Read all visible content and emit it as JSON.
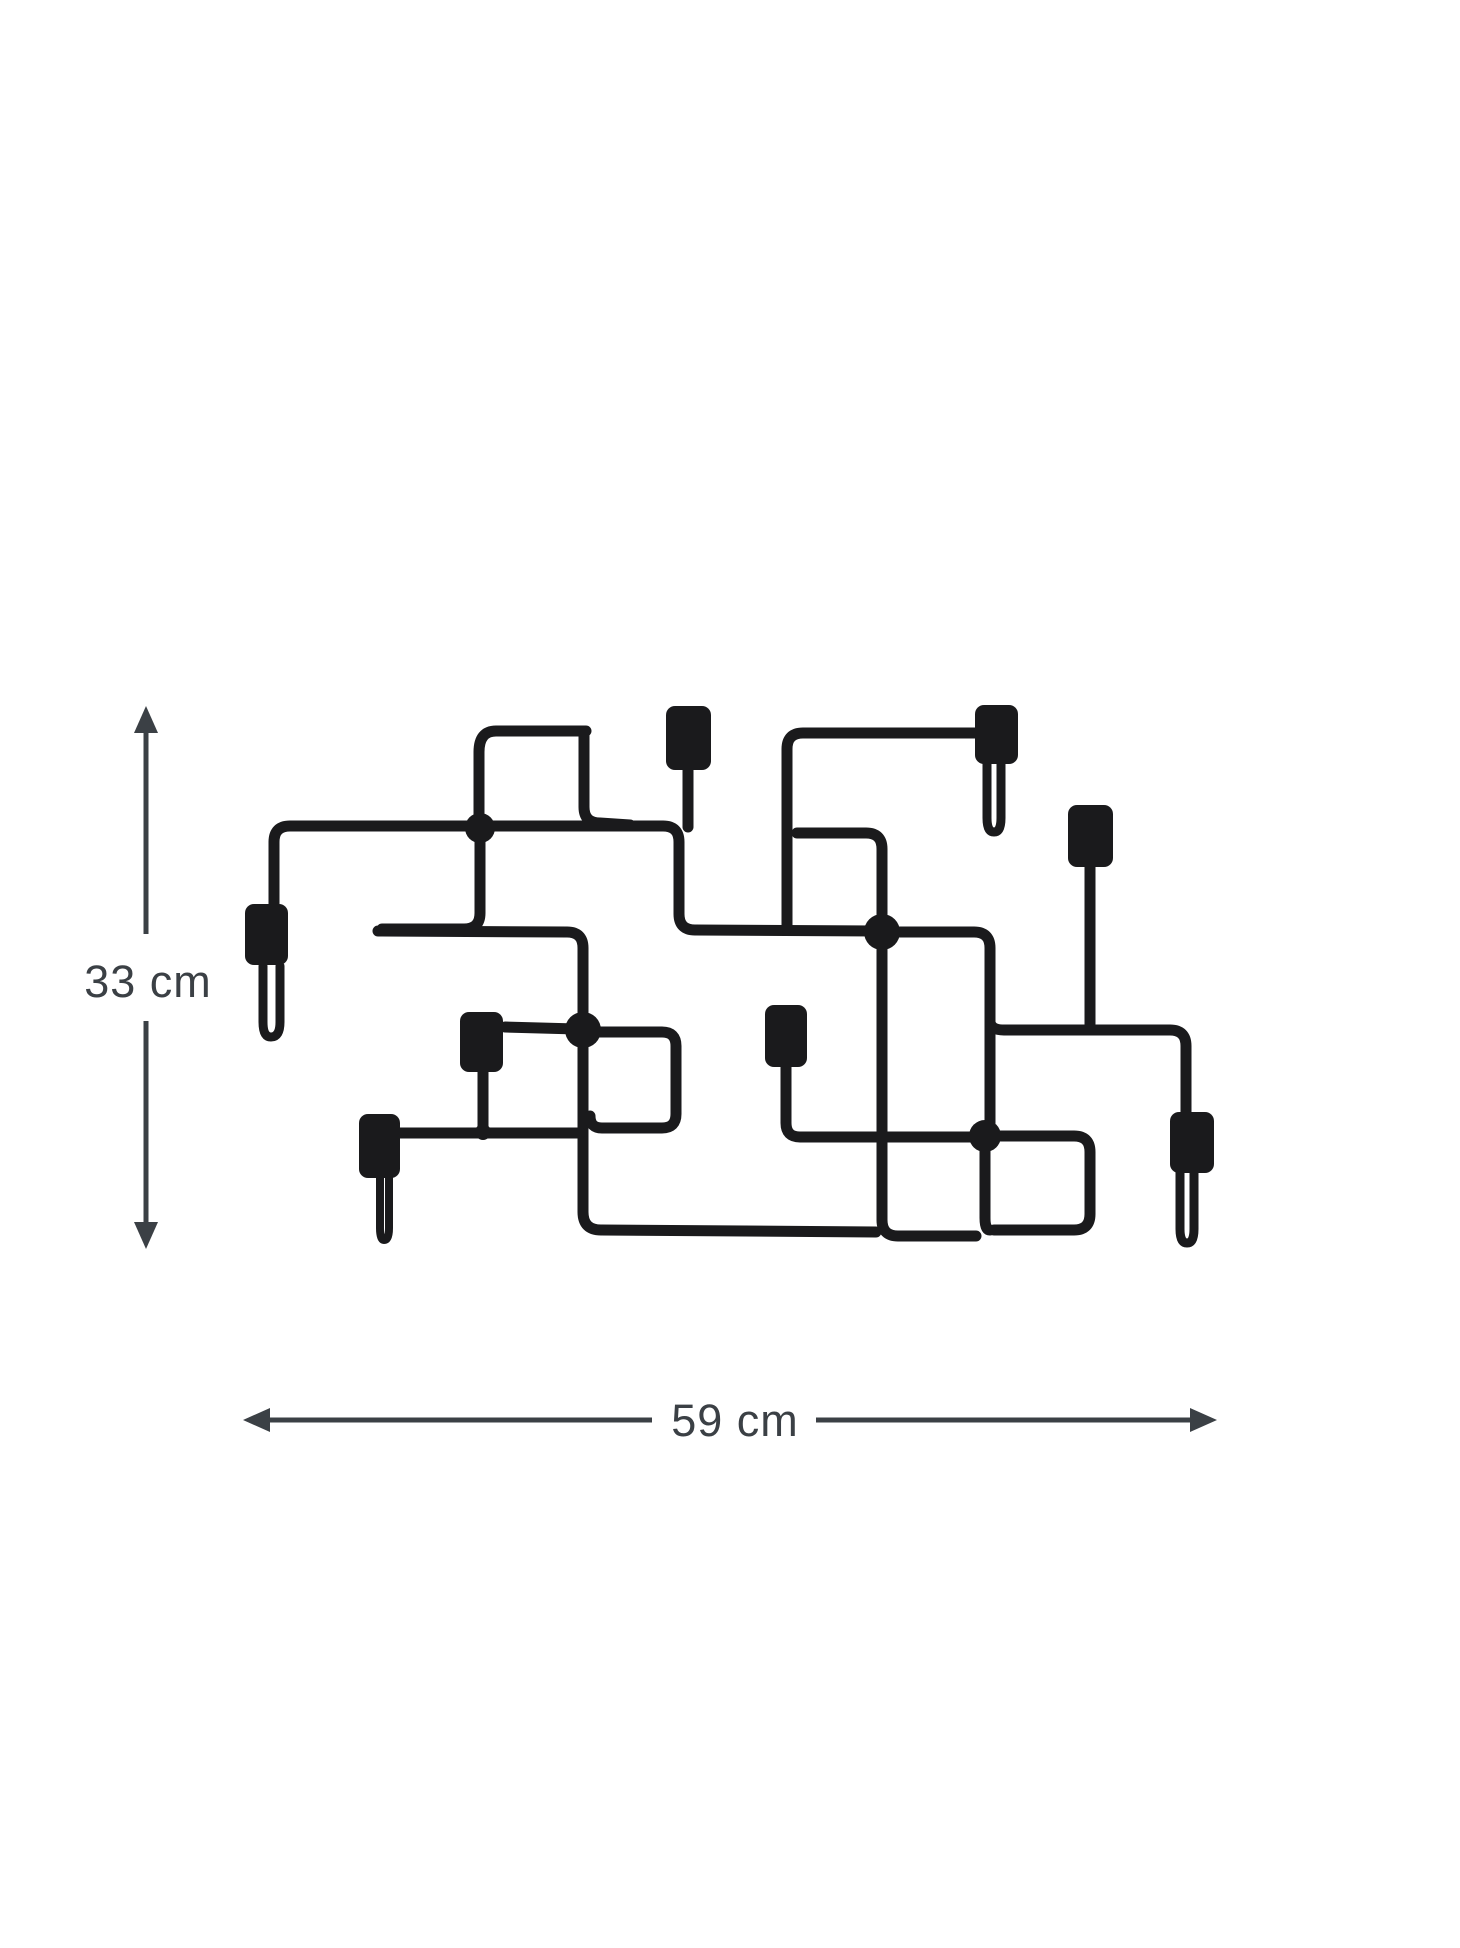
{
  "diagram": {
    "type": "product-dimension-diagram",
    "product": "wire-wall-coat-rack",
    "hooks_count": 8,
    "junction_dots_count": 4,
    "height_label": "33 cm",
    "width_label": "59 cm",
    "icons": {
      "vertical_dimension": "up-down-arrow-icon",
      "horizontal_dimension": "left-right-arrow-icon"
    },
    "colors": {
      "product": "#1a1a1c",
      "dimension_lines": "#3b4045",
      "label_text": "#3b4045",
      "background": "#ffffff"
    }
  }
}
